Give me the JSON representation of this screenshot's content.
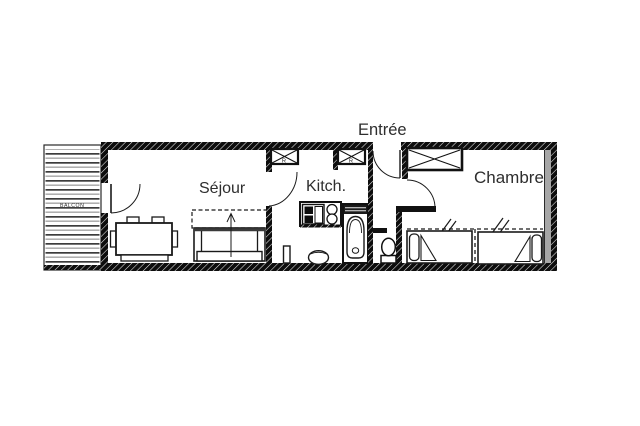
{
  "floorplan": {
    "title": "apartment-floor-plan",
    "labels": {
      "entry": "Entrée",
      "living": "Séjour",
      "kitchen": "Kitch.",
      "bedroom": "Chambre",
      "balcony": "BALCON",
      "closet_left": "R",
      "closet_mid": "R"
    },
    "colors": {
      "line": "#1a1a1a",
      "wall": "#0d0d0d",
      "gray_band": "#a6a6a6",
      "label_text": "#2e2e2e"
    }
  }
}
